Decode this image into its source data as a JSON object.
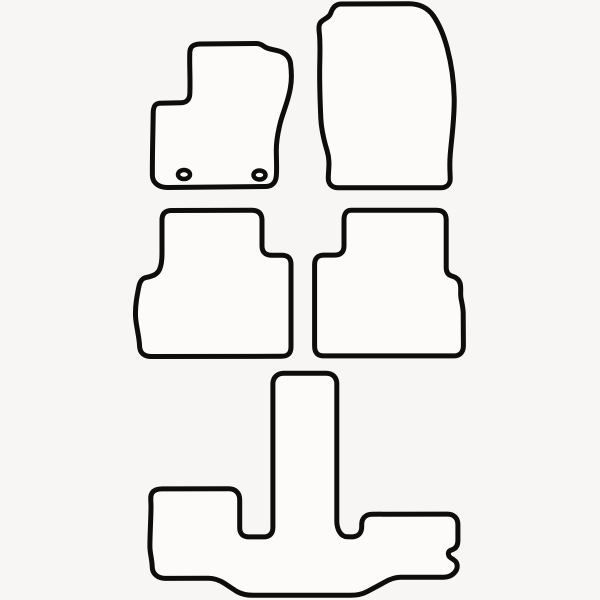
{
  "canvas": {
    "width": 600,
    "height": 600,
    "background": "#f7f6f4"
  },
  "style": {
    "stroke_color": "#0d0d0d",
    "stroke_width": 5,
    "fill_color": "#fcfbfa"
  },
  "figure": {
    "description": "Outline template drawing of a 5-piece tailored car floor mat set: two front mats, two rear mats and one long third-row T-shaped mat",
    "mats": [
      {
        "id": "front-left-driver-mat",
        "path": "M 200 44 C 220 43.7 240 43.5 256 43.5 C 262 43.5 263 46.5 267 48 C 272 50 277 50 281.5 52 C 286.5 54 289.5 57.5 290.5 63 C 291.5 71 292 79 290.5 87 C 288.5 101 282.5 113 280 124 C 277.8 133 276.3 141 276.3 150 C 276.3 159 277 168 276.3 176 C 275.8 182 272.5 186.5 265.5 186.5 L 168 187.5 C 159 187.6 152.5 183 152.4 175.5 C 152.2 155 153 132 153.2 113 C 153.3 107.5 154.5 103.8 159 103.3 L 181 102.8 C 186.5 102.7 189.5 99.5 189.8 94 C 190.5 80 189.3 65 189.8 52.5 C 190 46.5 193.5 44.2 200 44 Z",
        "holes": [
          {
            "cx": 184,
            "cy": 174.5,
            "rx": 6,
            "ry": 4.5,
            "stroke_width": 4.5
          },
          {
            "cx": 259.5,
            "cy": 175,
            "rx": 6,
            "ry": 4.5,
            "stroke_width": 4.5
          }
        ]
      },
      {
        "id": "front-right-passenger-mat",
        "path": "M 341 4 L 409 3.8 C 419 3.8 427.5 7.5 433.5 16 C 440 25.5 444 36 447.2 48 C 451 62.5 453.8 80 454.2 98 C 454.6 119 451.5 138 450.2 155 C 449.3 166 450.2 173 450.2 179 C 450.2 184.5 446.3 187.8 440.3 187.8 L 338.5 187.8 C 332.3 187.8 328.3 184.3 328.3 178.3 C 328.3 170 330.3 161.5 327.3 151.5 C 323.8 140 321.3 130 320.8 118 C 320 100 319.3 80 319.8 62 C 320 50 320.3 41 319.3 33 C 318.6 27 318.8 23.5 322 21 C 325.6 18.3 329.3 17.3 330.8 13 C 332.5 8 335.5 4.2 341 4 Z",
        "holes": []
      },
      {
        "id": "rear-left-mat",
        "path": "M 171 210.5 L 252 210.3 C 258.5 210.3 262 213.5 262 220 L 262 246 C 262 252 265.3 255.2 271.3 255.2 L 281.8 255.2 C 288 255.2 291 258.3 291 264.5 L 291 347 C 291 353.3 287.8 356.3 281.5 356.3 L 151.5 356.5 C 144.5 356.5 139.8 353 139.6 346.3 C 139.3 337 136.3 327 135.6 317.5 C 134.9 306.5 137 296 138.8 287 C 139.8 281.5 141.8 278.2 146.8 277.3 C 152.8 276.2 157.6 274.3 159.8 268.8 C 161.4 264.8 162 260.3 162 253.8 L 162 220 C 162 213.7 165.3 210.6 171 210.5 Z",
        "holes": []
      },
      {
        "id": "rear-right-mat",
        "path": "M 351 210.3 L 436.5 210.2 C 443 210.2 446.2 213.4 446.2 219.8 L 446.2 267.5 C 446.2 272 447.8 274.8 451.8 276 C 456.4 277.3 459.3 279.5 460.3 284.2 C 461.3 289 460.1 293.3 461 298.2 C 461.9 303 463 307 463.2 312.8 L 463.4 345.8 C 463.4 352.2 459.9 355.9 453.6 355.9 L 323.9 355.9 C 317.6 355.9 314.6 352.6 314.6 346.3 L 314.6 264.6 C 314.6 258.3 317.8 255.1 324.1 255.1 L 334.6 255.1 C 340.8 255.1 344 251.9 344 245.7 L 344 219.8 C 344 214 346.5 210.3 351 210.3 Z",
        "holes": []
      },
      {
        "id": "rear-long-third-row-mat",
        "path": "M 284 373.3 L 326 373.2 C 332.5 373.2 336.8 377.3 336.8 383.8 L 336.8 521 C 336.8 528.5 340.2 536.8 347.5 536.8 L 351.5 536.9 C 357.7 536.9 361.7 533.3 361.7 527 L 361.7 524.4 C 361.7 518.2 365.8 514.2 372 514.2 L 447.6 514.1 C 453.8 514.1 457.9 518.2 457.9 524.4 L 457.9 540.5 C 457.9 545.5 456 548.6 451.9 549.8 C 448.6 550.8 447.6 552.9 448.9 555.9 C 450.5 558.8 455.4 559.5 456.7 563.3 C 458 567.2 456.9 570.3 454 573.2 C 451 576.2 447.8 577.2 443.6 577.2 L 400.5 577.3 C 394.4 577.3 388.5 579.8 383.3 582.9 L 367.5 591.4 C 362.3 594.2 356.5 595.3 350.5 595.3 L 253.4 595.3 C 247.4 595.3 241.6 594.3 236.5 591.3 L 224.5 583.4 C 219.4 580.2 214.4 578.3 208.3 578.3 L 165.6 578.4 C 157.8 578.4 152.3 573.9 152.2 566.8 C 152.1 559.8 149.9 553.2 149.9 546.5 C 149.9 534 150.9 519.5 151 507.5 C 151.1 499.8 149.8 496.5 152.1 492.9 C 154.1 489.9 157.4 488.9 162 488.9 L 228.6 488.8 C 235.3 488.8 239.7 493 239.7 499.6 L 239.7 527.6 C 239.7 533.8 242.9 536.9 249.1 536.9 L 263.6 536.9 C 269.8 536.9 272.9 533.4 272.9 527.2 L 272.9 383.8 C 272.9 377.3 277.4 373.3 284 373.3 Z",
        "holes": []
      }
    ]
  }
}
